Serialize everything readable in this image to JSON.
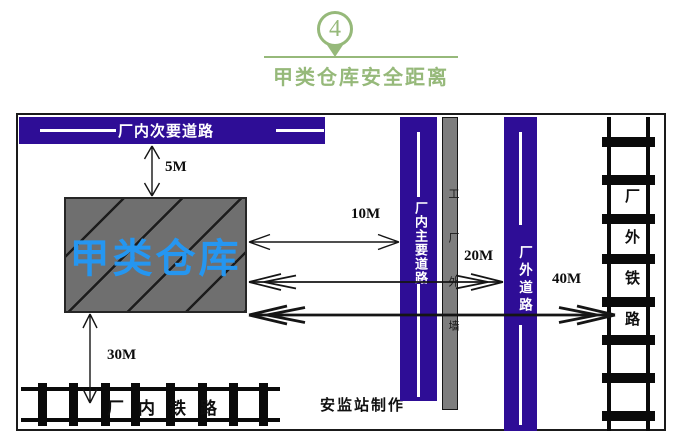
{
  "header": {
    "badge_number": "4",
    "title": "甲类仓库安全距离"
  },
  "diagram": {
    "secondary_road": "厂内次要道路",
    "warehouse": "甲类仓库",
    "main_road": "厂内主要道路",
    "factory_wall": "工厂外墙",
    "external_road": "厂外道路",
    "internal_railway": "厂内铁路",
    "external_railway": "厂外铁路",
    "credit": "安监站制作",
    "distances": {
      "warehouse_to_secondary_road": "5M",
      "warehouse_to_main_road": "10M",
      "warehouse_to_external_road": "20M",
      "warehouse_to_external_railway": "40M",
      "warehouse_to_internal_railway": "30M"
    }
  },
  "colors": {
    "title_green": "#96b97a",
    "road_purple": "#2e0d96",
    "warehouse_gray": "#6f6f6f",
    "wall_gray": "#7e7e7e",
    "warehouse_text_blue": "#2596f0",
    "line_black": "#111111"
  }
}
